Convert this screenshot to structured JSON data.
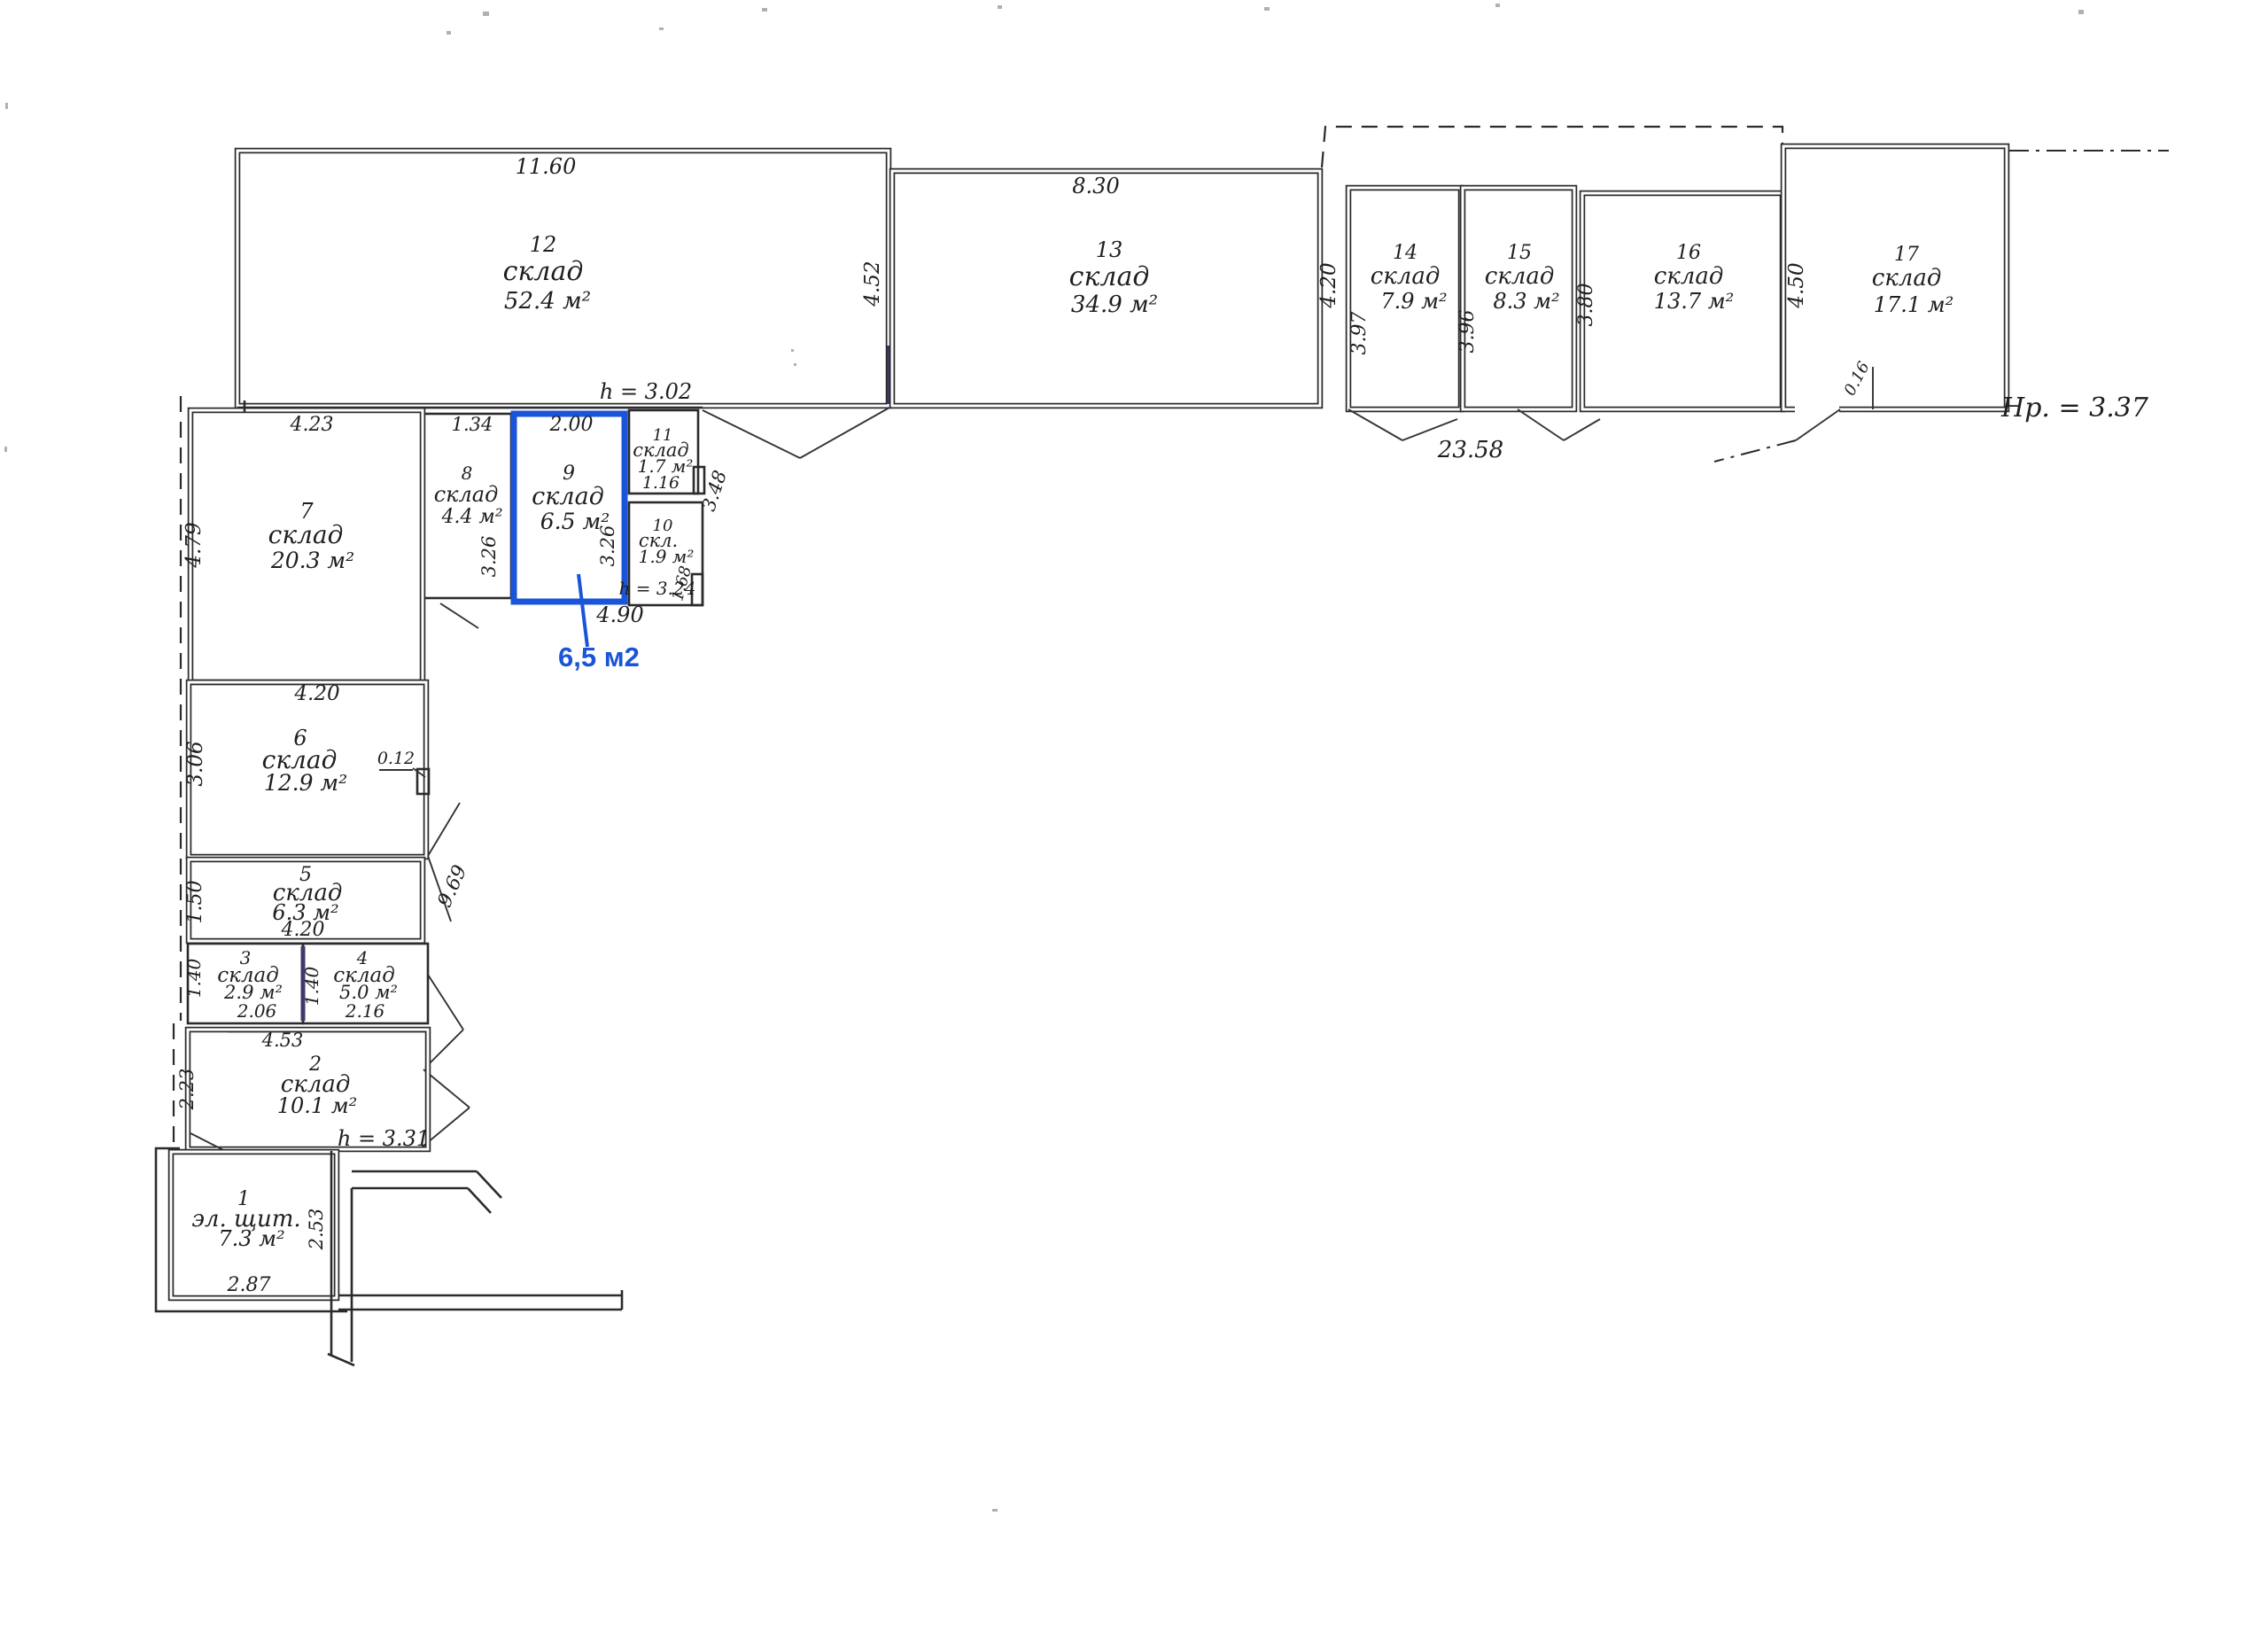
{
  "plan": {
    "accent": "#1a54d8",
    "ink": "#2b2b2b",
    "rooms": [
      {
        "number": "12",
        "name": "склад",
        "area": "52.4 м²"
      },
      {
        "number": "13",
        "name": "склад",
        "area": "34.9 м²"
      },
      {
        "number": "14",
        "name": "склад",
        "area": "7.9 м²"
      },
      {
        "number": "15",
        "name": "склад",
        "area": "8.3 м²"
      },
      {
        "number": "16",
        "name": "склад",
        "area": "13.7 м²"
      },
      {
        "number": "17",
        "name": "склад",
        "area": "17.1 м²"
      },
      {
        "number": "7",
        "name": "склад",
        "area": "20.3 м²"
      },
      {
        "number": "8",
        "name": "склад",
        "area": "4.4 м²"
      },
      {
        "number": "9",
        "name": "склад",
        "area": "6.5 м²"
      },
      {
        "number": "10",
        "name": "скл.",
        "area": "1.9 м²"
      },
      {
        "number": "11",
        "name": "склад",
        "area": "1.7 м²"
      },
      {
        "number": "6",
        "name": "склад",
        "area": "12.9 м²"
      },
      {
        "number": "5",
        "name": "склад",
        "area": "6.3 м²"
      },
      {
        "number": "3",
        "name": "склад",
        "area": "2.9 м²"
      },
      {
        "number": "4",
        "name": "склад",
        "area": "5.0 м²"
      },
      {
        "number": "2",
        "name": "склад",
        "area": "10.1 м²"
      },
      {
        "number": "1",
        "name": "эл. щит.",
        "area": "7.3 м²"
      }
    ],
    "dims": {
      "w11_60": "11.60",
      "w8_30": "8.30",
      "w4_52": "4.52",
      "w4_20_13": "4.20",
      "w3_97": "3.97",
      "w3_96": "3.96",
      "w3_80": "3.80",
      "w4_50": "4.50",
      "w0_16": "0.16",
      "w23_58": "23.58",
      "h12": "h = 3.02",
      "w1_34": "1.34",
      "w3_26_8": "3.26",
      "w2_00": "2.00",
      "w3_26_9": "3.26",
      "w4_90": "4.90",
      "w1_16": "1.16",
      "w3_48": "3.48",
      "h10": "h = 3.24",
      "w1_68": "1.68",
      "w4_23": "4.23",
      "w4_79": "4.79",
      "w4_20_6": "4.20",
      "w3_06": "3.06",
      "w0_12": "0.12",
      "w1_50": "1.50",
      "w4_20_5": "4.20",
      "w9_69": "9.69",
      "w1_40_3": "1.40",
      "w2_06": "2.06",
      "w1_40_4": "1.40",
      "w2_16": "2.16",
      "w4_53": "4.53",
      "w2_23": "2.23",
      "h2": "h = 3.31",
      "w2_87": "2.87",
      "w2_53": "2.53"
    },
    "notes": {
      "hp": "Нр. = 3.37",
      "highlight": "6,5 м2"
    }
  }
}
